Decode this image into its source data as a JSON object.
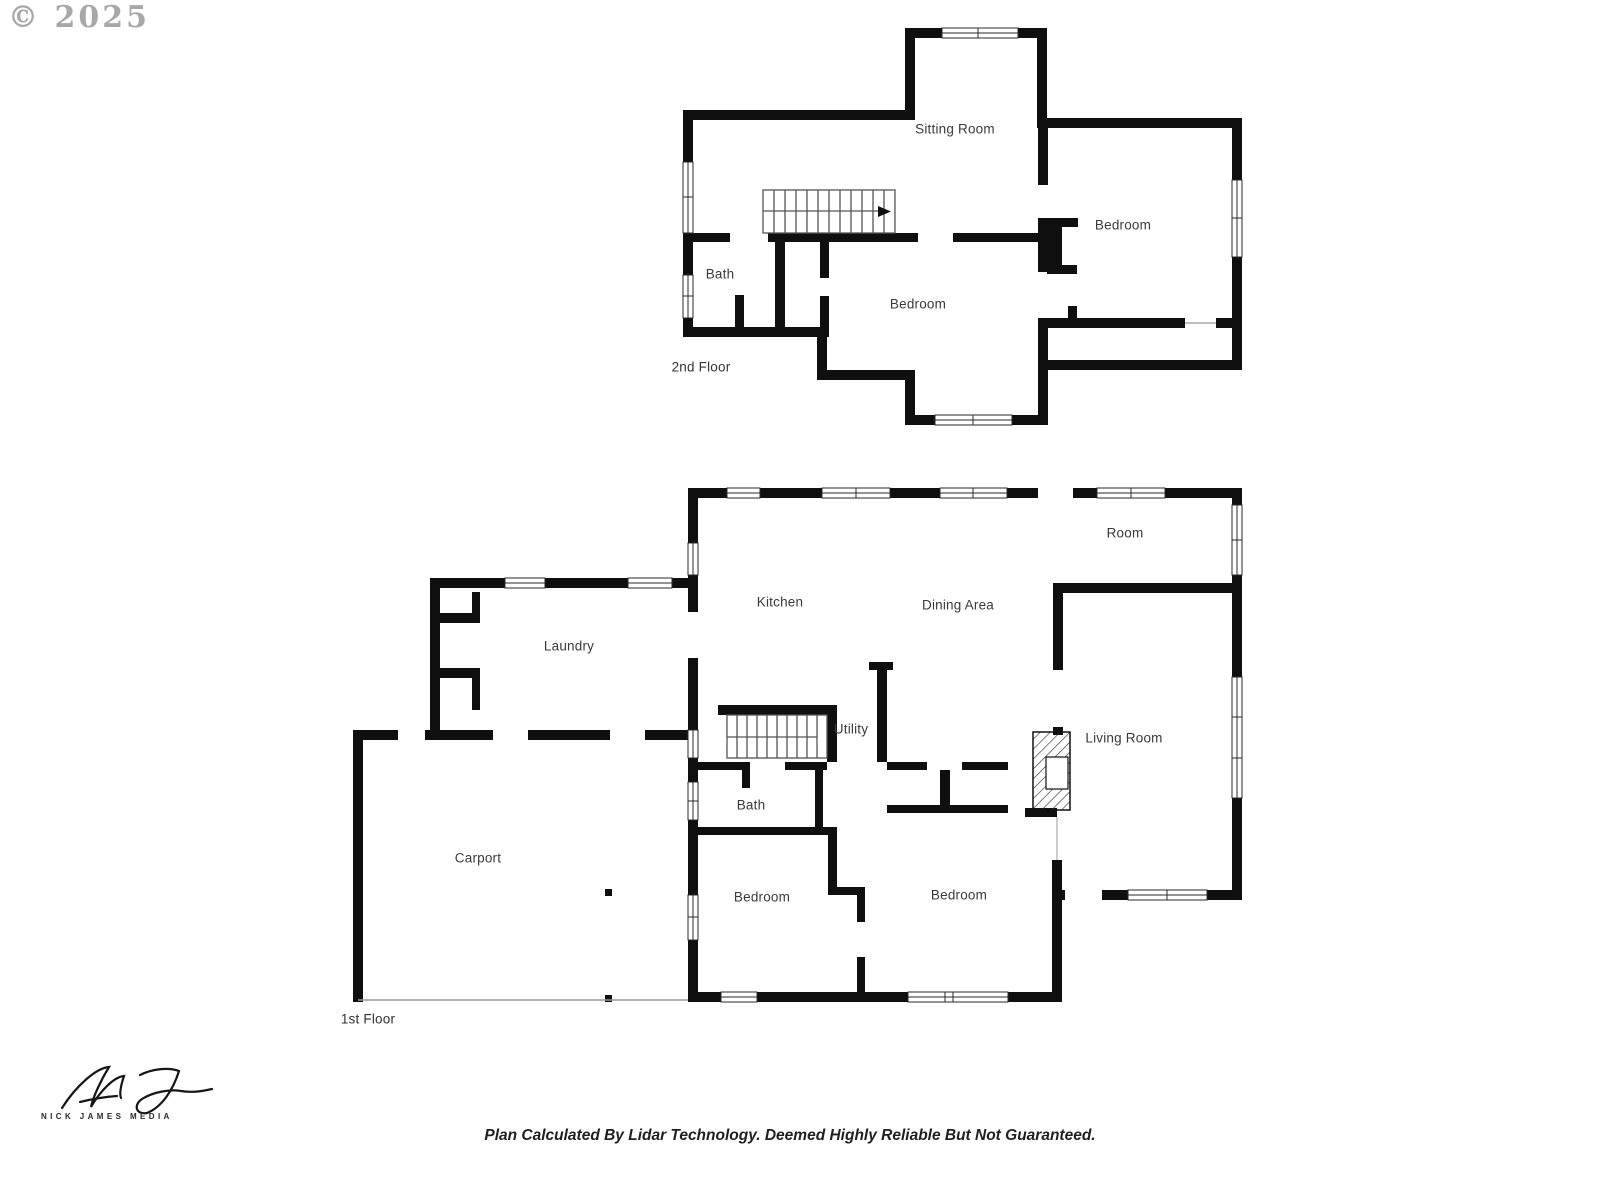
{
  "watermark": "© 2025",
  "second_floor": {
    "title": "2nd Floor",
    "rooms": [
      "Sitting Room",
      "Bedroom",
      "Bath",
      "Bedroom"
    ]
  },
  "first_floor": {
    "title": "1st Floor",
    "rooms": [
      "Room",
      "Kitchen",
      "Dining Area",
      "Laundry",
      "Utility",
      "Living Room",
      "Bath",
      "Carport",
      "Bedroom",
      "Bedroom"
    ]
  },
  "footer": {
    "signature_brand": "NICK JAMES MEDIA",
    "disclaimer": "Plan Calculated By Lidar Technology. Deemed Highly Reliable But Not Guaranteed."
  },
  "colors": {
    "wall": "#0f0f0f",
    "label": "#3a3a3a",
    "watermark": "#9a9a9a"
  }
}
